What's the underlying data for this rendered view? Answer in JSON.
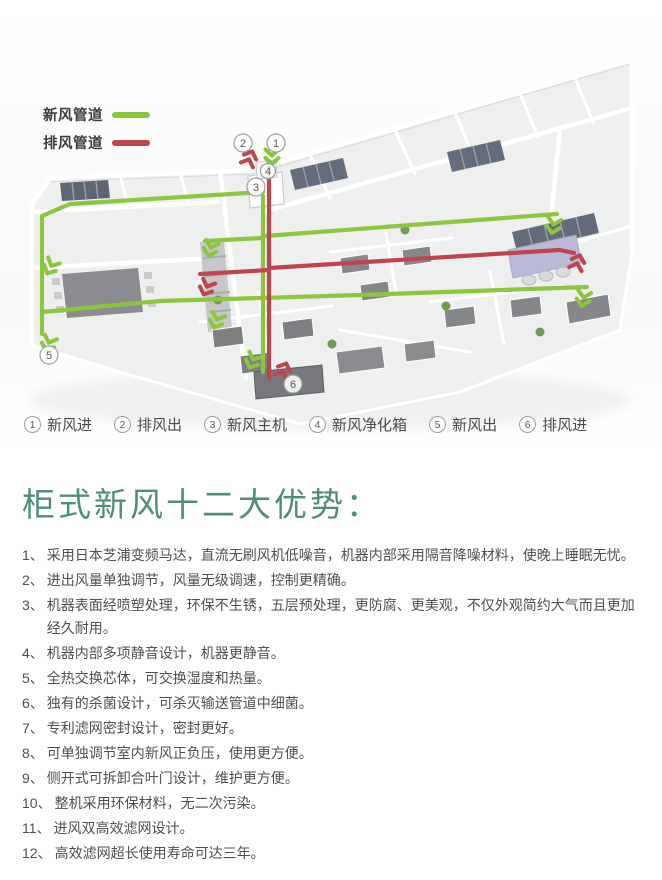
{
  "colors": {
    "green": "#8cc63e",
    "red": "#bf4450",
    "teal": "#4f8e76",
    "ink": "#4f4f4f"
  },
  "duct_legend": {
    "fresh": "新风管道",
    "exhaust": "排风管道"
  },
  "diagram": {
    "markers": [
      "1",
      "2",
      "3",
      "4",
      "5",
      "6"
    ]
  },
  "marker_legend": [
    {
      "num": "1",
      "label": "新风进"
    },
    {
      "num": "2",
      "label": "排风出"
    },
    {
      "num": "3",
      "label": "新风主机"
    },
    {
      "num": "4",
      "label": "新风净化箱"
    },
    {
      "num": "5",
      "label": "新风出"
    },
    {
      "num": "6",
      "label": "排风进"
    }
  ],
  "advantages": {
    "title": "柜式新风十二大优势：",
    "items": [
      {
        "num": "1、",
        "text": "采用日本芝浦变频马达，直流无刷风机低噪音，机器内部采用隔音降噪材料，使晚上睡眠无忧。"
      },
      {
        "num": "2、",
        "text": "进出风量单独调节，风量无级调速，控制更精确。"
      },
      {
        "num": "3、",
        "text": "机器表面经喷塑处理，环保不生锈，五层预处理，更防腐、更美观，不仅外观简约大气而且更加经久耐用。"
      },
      {
        "num": "4、",
        "text": "机器内部多项静音设计，机器更静音。"
      },
      {
        "num": "5、",
        "text": "全热交换芯体，可交换湿度和热量。"
      },
      {
        "num": "6、",
        "text": "独有的杀菌设计，可杀灭输送管道中细菌。"
      },
      {
        "num": "7、",
        "text": "专利滤网密封设计，密封更好。"
      },
      {
        "num": "8、",
        "text": "可单独调节室内新风正负压，使用更方便。"
      },
      {
        "num": "9、",
        "text": "侧开式可拆卸合叶门设计，维护更方便。"
      },
      {
        "num": "10、",
        "text": "整机采用环保材料，无二次污染。"
      },
      {
        "num": "11、",
        "text": "进风双高效滤网设计。"
      },
      {
        "num": "12、",
        "text": "高效滤网超长使用寿命可达三年。"
      }
    ]
  }
}
